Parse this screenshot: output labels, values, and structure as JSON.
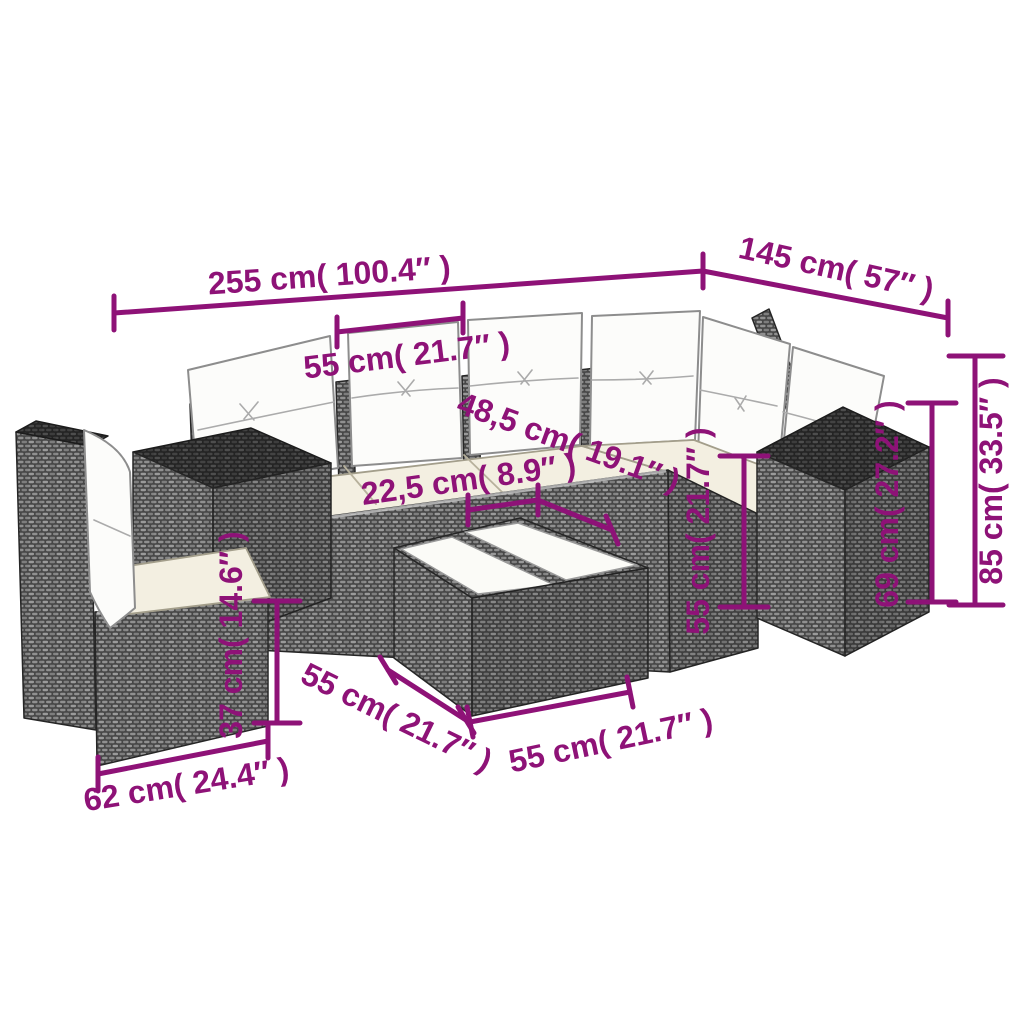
{
  "colors": {
    "dimension": "#8e1277",
    "wicker": "#474747",
    "wicker_top": "#242424",
    "cushion": "#fcfcfa",
    "seat_cushion": "#f3efe1",
    "background": "#ffffff"
  },
  "dimensions": {
    "total_width": {
      "label": "255 cm( 100.4″ )"
    },
    "total_depth": {
      "label": "145 cm( 57″ )"
    },
    "seat_width": {
      "label": "55 cm( 21.7″ )"
    },
    "seat_depth": {
      "label": "48,5 cm( 19.1″ )"
    },
    "front_rail": {
      "label": "22,5 cm( 8.9″ )"
    },
    "back_height": {
      "label": "85 cm( 33.5″ )"
    },
    "cube_height": {
      "label": "69 cm( 27.2″ )"
    },
    "corner_height": {
      "label": "55 cm( 21.7″ )"
    },
    "base_height": {
      "label": "37 cm( 14.6″ )"
    },
    "chair_width": {
      "label": "62 cm( 24.4″ )"
    },
    "table_side_a": {
      "label": "55 cm( 21.7″ )"
    },
    "table_side_b": {
      "label": "55 cm( 21.7″ )"
    }
  }
}
